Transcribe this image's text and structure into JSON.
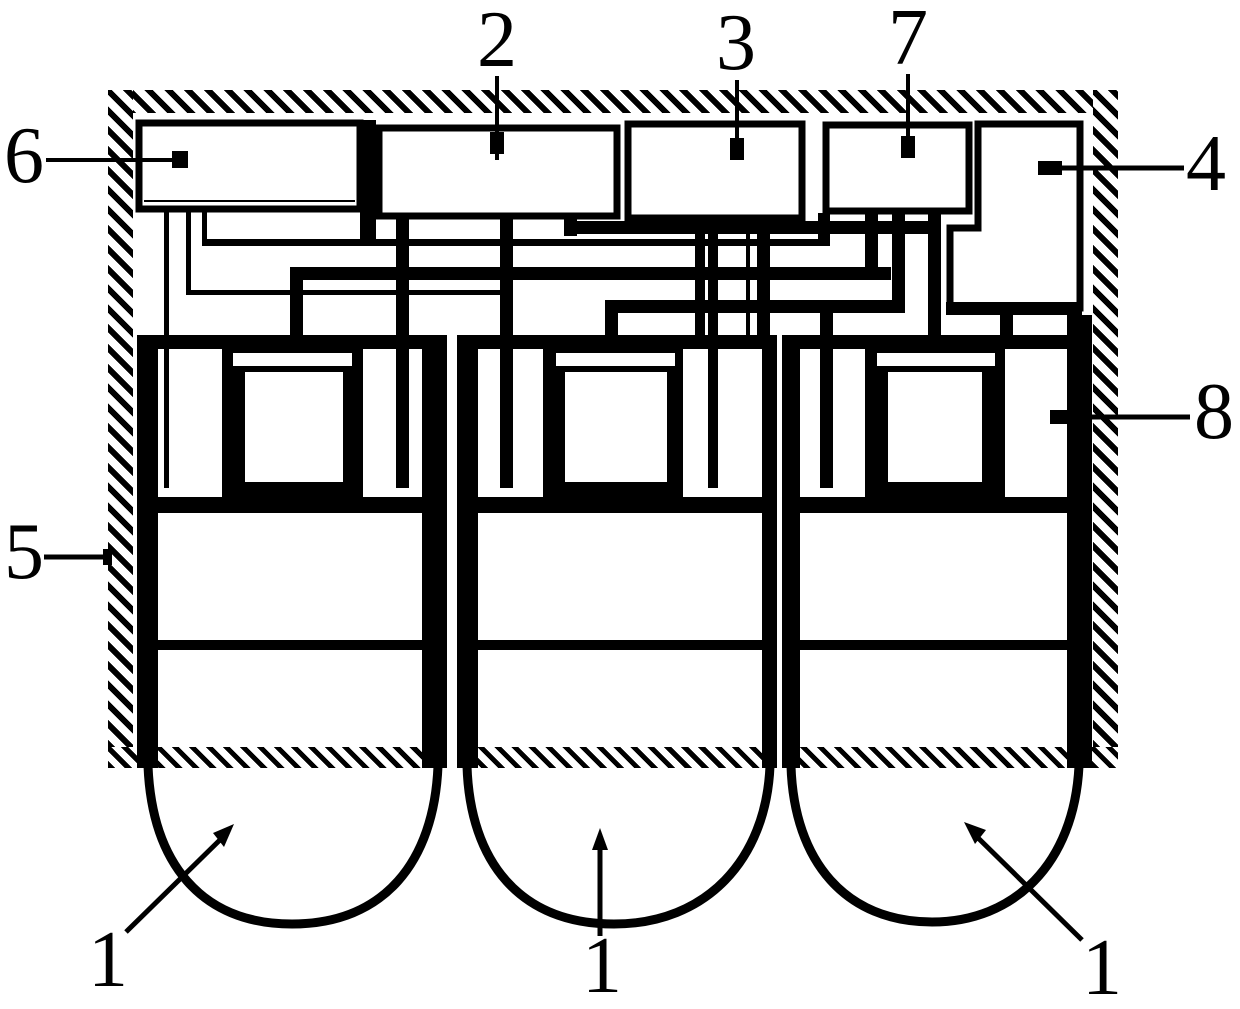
{
  "diagram": {
    "type": "patent-cross-section-figure",
    "background_color": "#ffffff",
    "ink_color": "#000000",
    "callouts": {
      "c6": {
        "label": "6"
      },
      "c2": {
        "label": "2"
      },
      "c3": {
        "label": "3"
      },
      "c7": {
        "label": "7"
      },
      "c4": {
        "label": "4"
      },
      "c5": {
        "label": "5"
      },
      "c8": {
        "label": "8"
      },
      "c1_left": {
        "label": "1"
      },
      "c1_middle": {
        "label": "1"
      },
      "c1_right": {
        "label": "1"
      }
    }
  }
}
